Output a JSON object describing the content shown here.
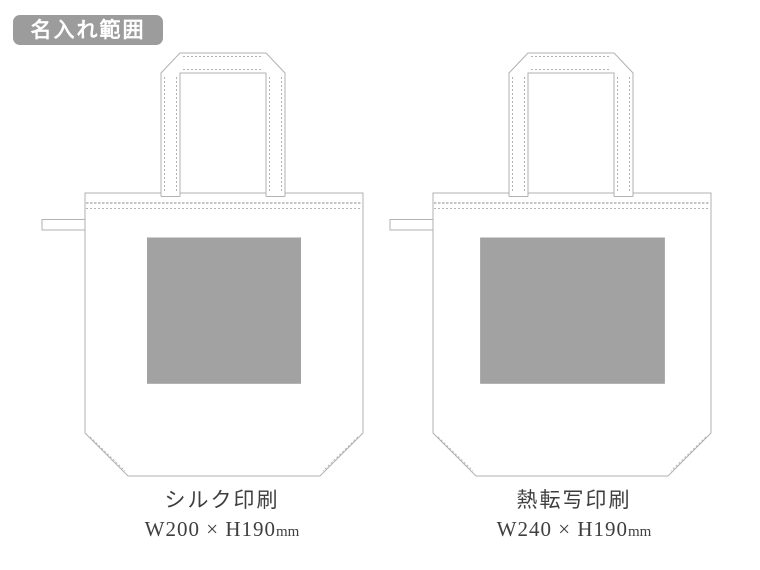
{
  "badge": {
    "label": "名入れ範囲"
  },
  "bags": [
    {
      "method": "シルク印刷",
      "size": "W200 × H190",
      "unit": "mm",
      "print_area": {
        "w_mm": 200,
        "h_mm": 190
      }
    },
    {
      "method": "熱転写印刷",
      "size": "W240 × H190",
      "unit": "mm",
      "print_area": {
        "w_mm": 240,
        "h_mm": 190
      }
    }
  ],
  "colors": {
    "background": "#ffffff",
    "outline": "#b2b2b2",
    "print_area_fill": "#a2a2a2",
    "badge_bg": "#9c9c9c",
    "badge_text": "#ffffff",
    "label_text": "#3f3f3f"
  }
}
